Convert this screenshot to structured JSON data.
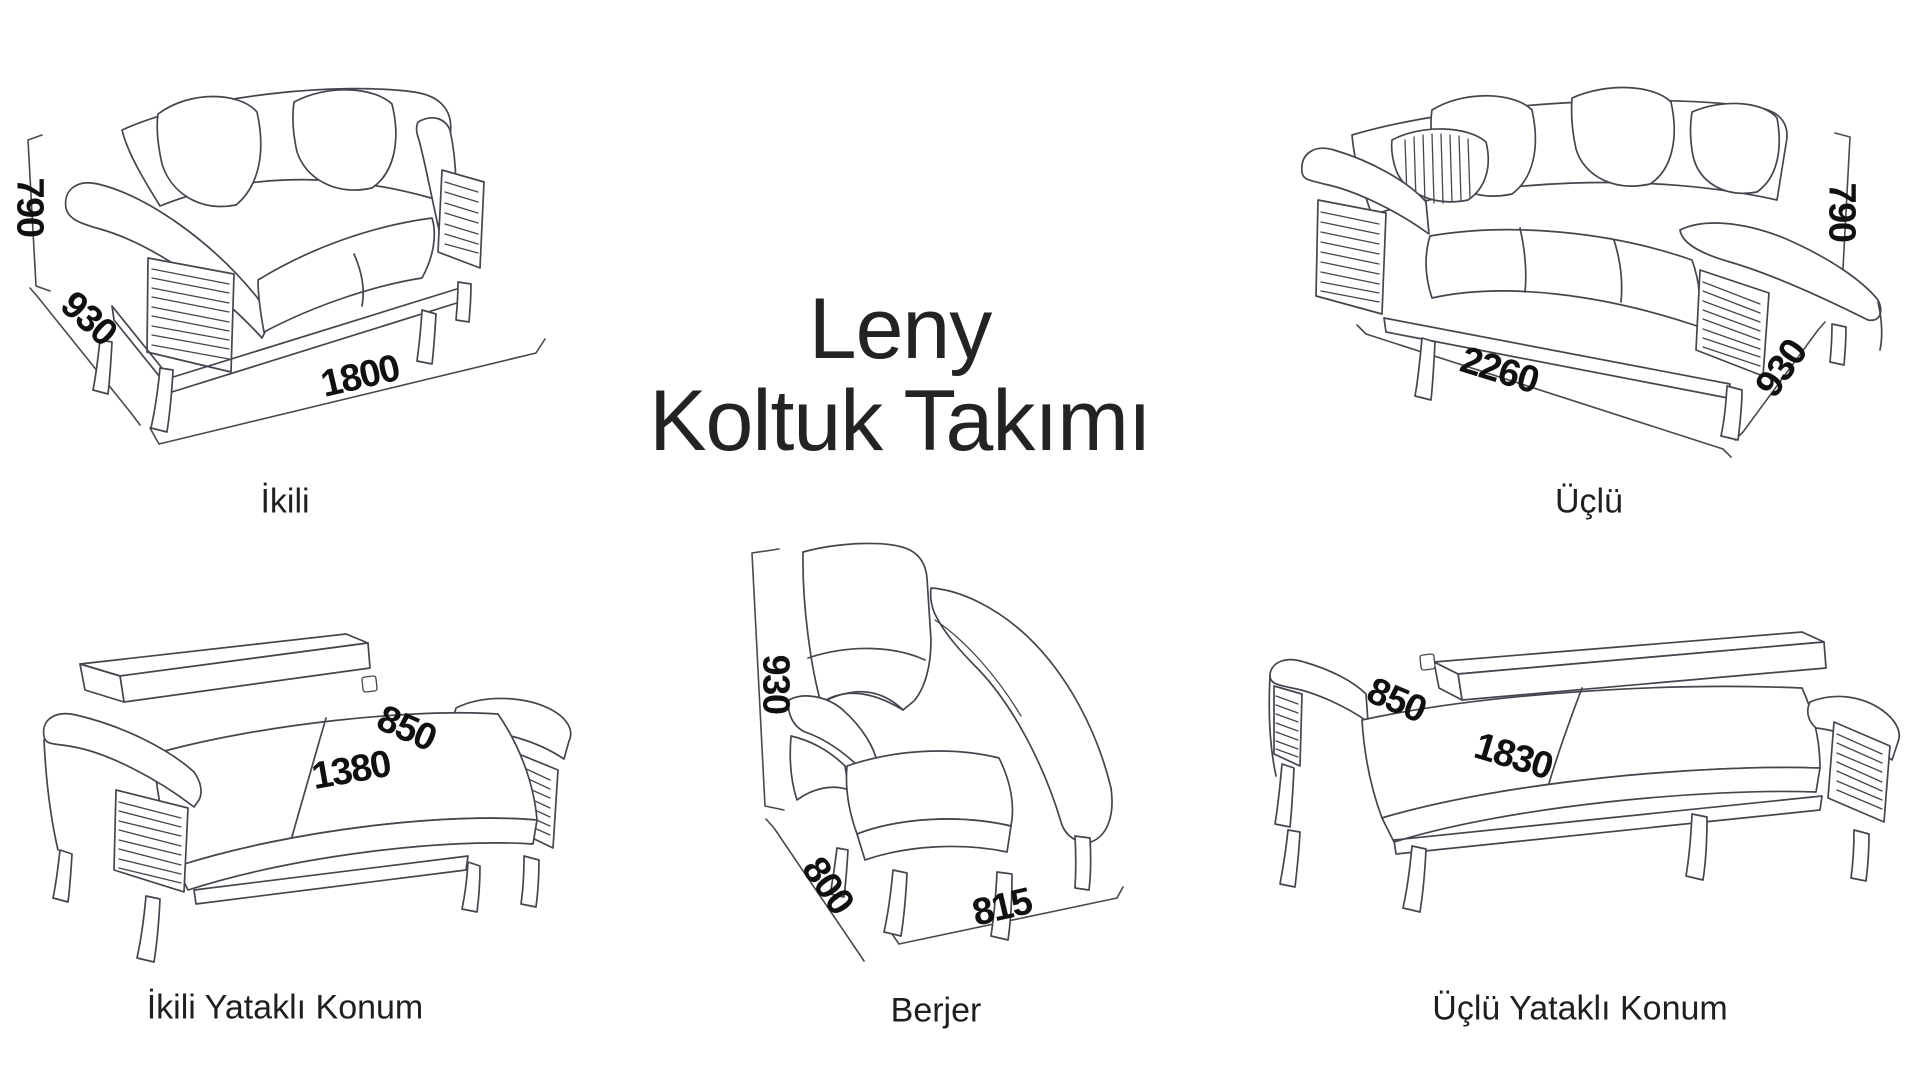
{
  "title": {
    "line1": "Leny",
    "line2": "Koltuk Takımı"
  },
  "items": [
    {
      "id": "ikili",
      "label": "İkili",
      "dims": {
        "height": "790",
        "depth": "930",
        "width": "1800"
      }
    },
    {
      "id": "uclu",
      "label": "Üçlü",
      "dims": {
        "height": "790",
        "depth": "930",
        "width": "2260"
      }
    },
    {
      "id": "ikili-yatakli",
      "label": "İkili Yataklı Konum",
      "dims": {
        "depth": "850",
        "width": "1380"
      }
    },
    {
      "id": "berjer",
      "label": "Berjer",
      "dims": {
        "height": "930",
        "depth": "800",
        "width": "815"
      }
    },
    {
      "id": "uclu-yatakli",
      "label": "Üçlü Yataklı Konum",
      "dims": {
        "depth": "850",
        "width": "1830"
      }
    }
  ],
  "colors": {
    "background": "#ffffff",
    "line_art": "#45454f",
    "text": "#1f1f1f",
    "dimension_text": "#101010"
  }
}
